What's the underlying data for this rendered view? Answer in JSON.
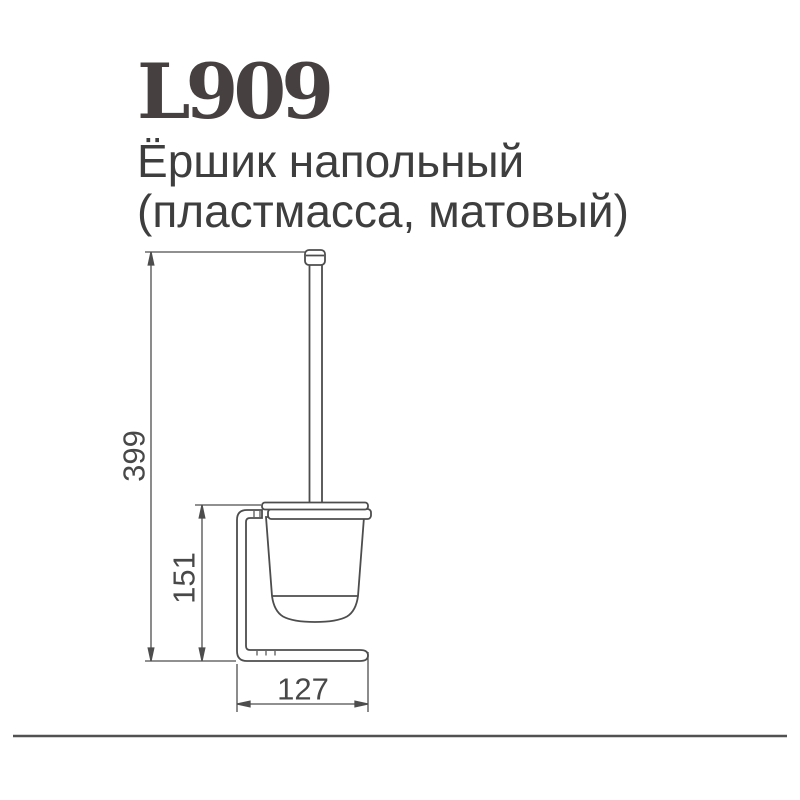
{
  "header": {
    "product_code": "L909",
    "product_name_line1": "Ёршик напольный",
    "product_name_line2": "(пластмасса, матовый)"
  },
  "drawing": {
    "kind": "technical-dimension-drawing",
    "subject": "floor-standing toilet brush with holder, side view",
    "unit": "mm",
    "dimensions": {
      "total_height": "399",
      "holder_height": "151",
      "base_width": "127"
    }
  },
  "colors": {
    "title_text": "#474040",
    "body_text": "#3e3e3e",
    "line_art": "#4d4d4d",
    "dimension_text": "#484848",
    "divider": "#515151",
    "background": "#ffffff"
  }
}
